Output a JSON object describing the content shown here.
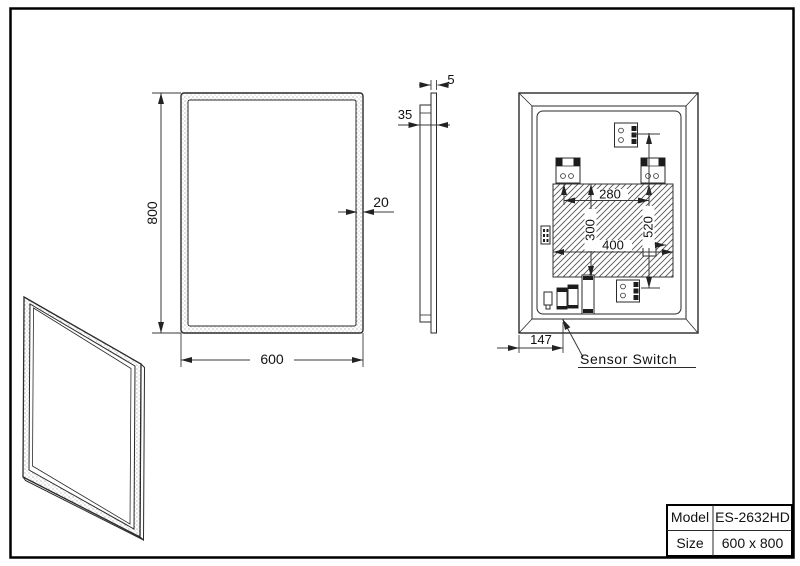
{
  "drawing": {
    "front_view": {
      "height": "800",
      "width": "600",
      "frame_thickness": "20"
    },
    "side_view": {
      "glass_thickness": "5",
      "total_depth": "35"
    },
    "back_view": {
      "hole_spacing": "280",
      "led_zone_height": "300",
      "led_zone_width": "400",
      "bracket_span": "520",
      "sensor_offset": "147",
      "sensor_label": "Sensor Switch"
    },
    "title_block": {
      "model_label": "Model",
      "model_value": "ES-2632HD",
      "size_label": "Size",
      "size_value": "600 x 800"
    },
    "colors": {
      "line": "#2a2a2a",
      "background": "#ffffff"
    }
  }
}
